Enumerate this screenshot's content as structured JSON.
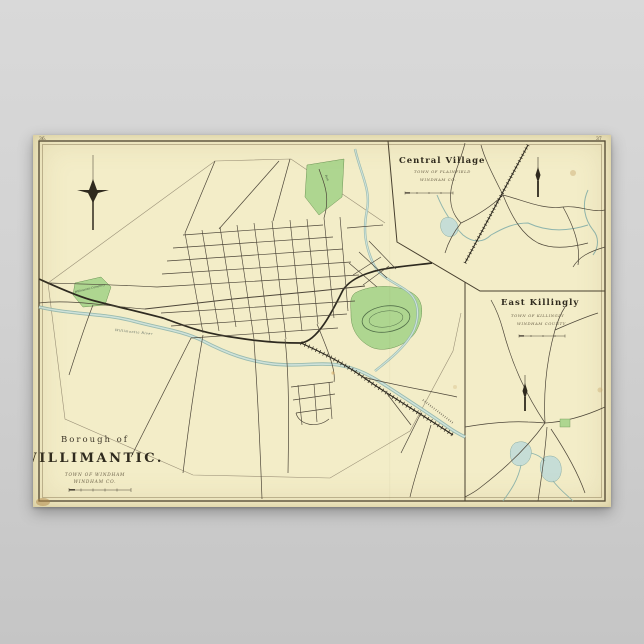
{
  "page": {
    "left_number": "36.",
    "right_number": "37"
  },
  "main_map": {
    "title_line1": "Borough of",
    "title_line2": "WILLIMANTIC.",
    "subtitle_line1": "TOWN OF WINDHAM",
    "subtitle_line2": "WINDHAM CO.",
    "labels": {
      "cemetery": "Willimantic Cemetery",
      "park": "Park",
      "river": "Willimantic River"
    }
  },
  "inset_central_village": {
    "title": "Central Village",
    "subtitle_line1": "TOWN OF PLAINFIELD",
    "subtitle_line2": "WINDHAM CO."
  },
  "inset_east_killingly": {
    "title": "East Killingly",
    "subtitle_line1": "TOWN OF KILLINGLY",
    "subtitle_line2": "WINDHAM COUNTY."
  },
  "colors": {
    "paper": "#f3edc8",
    "background": "#d0d0d0",
    "ink": "#4d4639",
    "water": "#8fb5ad",
    "park_green": "#aed690",
    "rail": "#2e2a20"
  }
}
